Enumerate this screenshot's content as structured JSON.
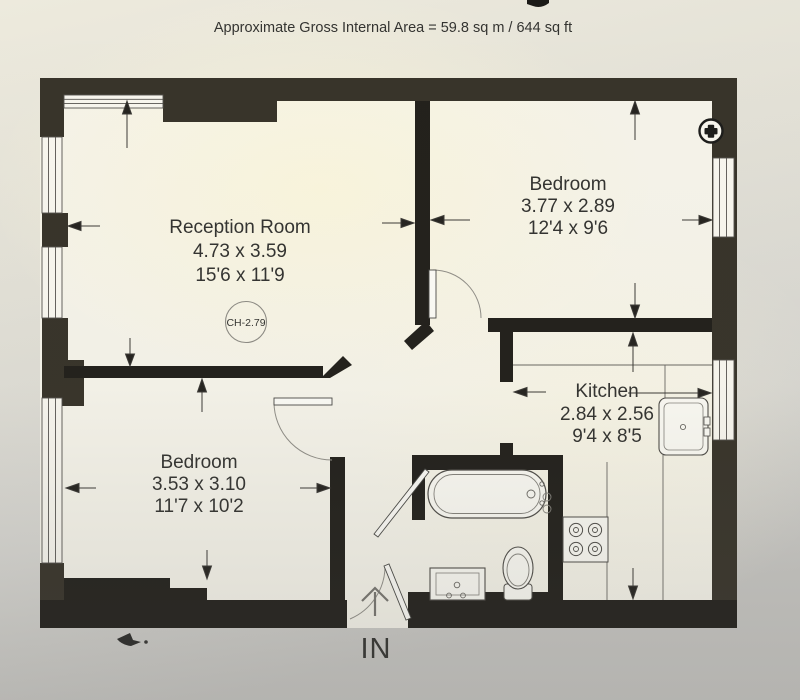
{
  "header": {
    "area_note": "Approximate Gross Internal Area = 59.8 sq m / 644 sq ft"
  },
  "rooms": {
    "reception": {
      "name": "Reception Room",
      "metric": "4.73 x 3.59",
      "imperial": "15'6 x 11'9",
      "ceiling_height": "CH-2.79"
    },
    "bedroom_top": {
      "name": "Bedroom",
      "metric": "3.77 x 2.89",
      "imperial": "12'4 x 9'6"
    },
    "kitchen": {
      "name": "Kitchen",
      "metric": "2.84 x 2.56",
      "imperial": "9'4 x 8'5"
    },
    "bedroom_bottom": {
      "name": "Bedroom",
      "metric": "3.53 x 3.10",
      "imperial": "11'7 x 10'2"
    }
  },
  "entrance": {
    "label": "IN"
  },
  "colors": {
    "wall_exterior": "#38342a",
    "wall_interior": "#23211c",
    "thin_line": "#55534e",
    "arc_line": "#908e87",
    "text": "#343431",
    "fixture_fill": "#faf9f2",
    "paper": "#f5f3e9"
  }
}
